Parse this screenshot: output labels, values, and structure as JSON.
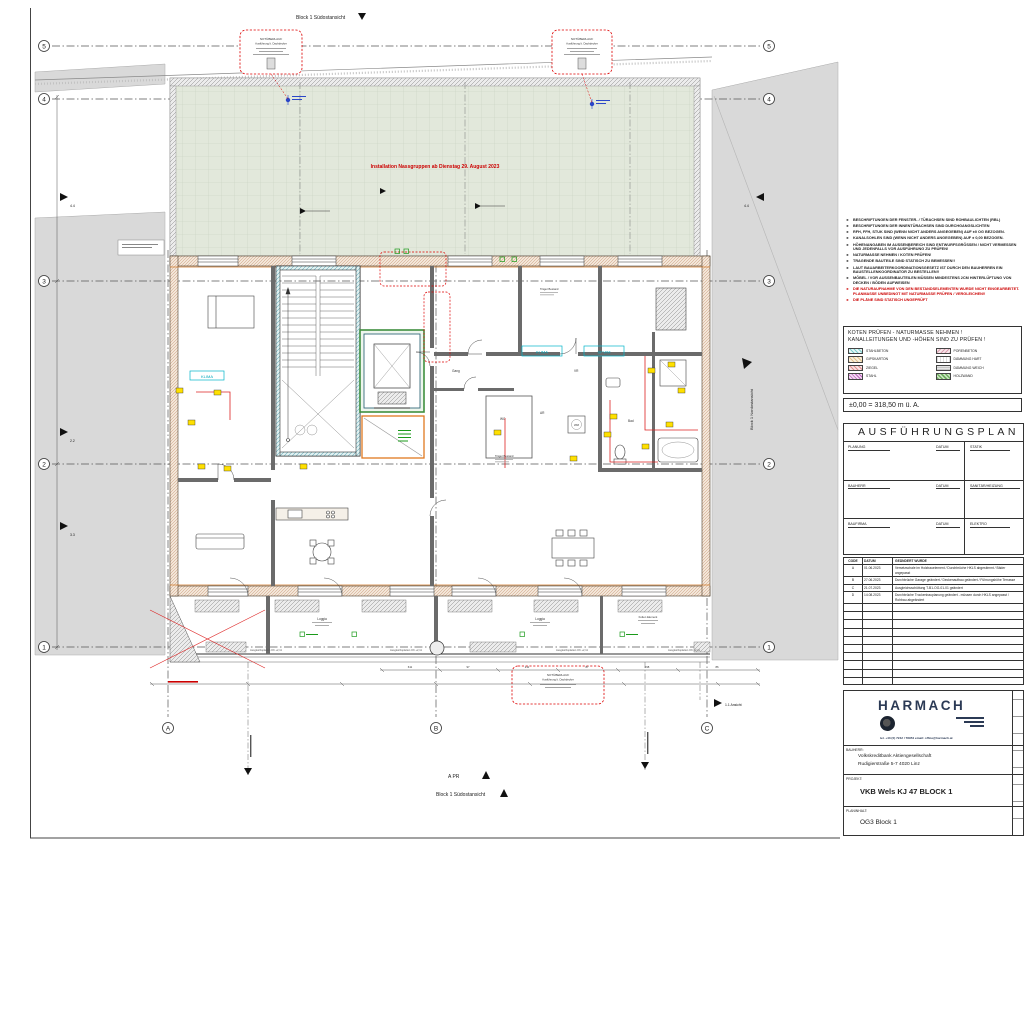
{
  "sheet": {
    "axis_rows": [
      "5",
      "4",
      "3",
      "2",
      "1"
    ],
    "axis_cols": [
      "A",
      "B",
      "C"
    ],
    "view_labels": {
      "top": "Block 1 Südostansicht",
      "bottom": "Block 1 Südostansicht",
      "right": "Block 1 Nordostansicht",
      "a_pr": "A PR",
      "ansicht_11": "1.1 Ansicht",
      "sec_44": "4.4",
      "sec_22": "2.2",
      "sec_33": "3.3"
    },
    "terrace_note": "Installation Nassgruppen ab Dienstag 29. August 2023",
    "overflow_label": {
      "title": "NOTÜBERLAUF",
      "subtitle": "Ausführung lt. Dachdecker"
    },
    "room_labels": {
      "loggia": "Loggia",
      "gang": "Gang",
      "bad": "Bad",
      "wc": "WC",
      "ar": "AR",
      "vr": "VR",
      "wm": "WM",
      "klima": "KLIMA",
      "spwm": "SP.WM",
      "traeger": "Träger Bestand",
      "folien": "Folien Element"
    },
    "plate_note": "Ausgleichsplatten OK +2,11",
    "dims_bottom": [
      "611",
      "97",
      "211",
      "87",
      "298",
      "86"
    ]
  },
  "notes": {
    "items": [
      {
        "text": "BESCHRIFTUNGEN DER FENSTER- / TÜRACHSEN SIND ROHBAULICHTEN (RBL)",
        "color": "#222222"
      },
      {
        "text": "BESCHRIFTUNGEN DER INNENTÜRACHSEN SIND DURCHGANGSLICHTEN",
        "color": "#222222"
      },
      {
        "text": "RFH, FFH, STUK SIND (WENN NICHT ANDERS ANGEGEBEN) AUF ±0 OG BEZOGEN.",
        "color": "#222222"
      },
      {
        "text": "KANALSOHLEN SIND (WENN NICHT ANDERS ANGEGEBEN) AUF ± 0,00 BEZOGEN.",
        "color": "#222222"
      },
      {
        "text": "HÖHENANGABEN IM AUSSENBEREICH SIND ENTWURFSGRÖSSEN / NICHT VERMESSEN UND JEDENFALLS VOR AUSFÜHRUNG ZU PRÜFEN!",
        "color": "#222222"
      },
      {
        "text": "NATURMASSE NEHMEN / KOTEN PRÜFEN!",
        "color": "#222222"
      },
      {
        "text": "TRAGENDE BAUTEILE SIND STATISCH ZU BEMESSEN!!",
        "color": "#222222"
      },
      {
        "text": "LAUT BAUARBEITERKOORDINATIONSGESETZ IST DURCH DEN BAUHERREN EIN BAUSTELLENKOORDINATOR ZU BESTELLEN!!",
        "color": "#222222"
      },
      {
        "text": "MÖBEL / VOR AUSSENBAUTEILEN MÜSSEN MINDESTENS 2CM HINTERLÜFTUNG VON DECKEN / BÖDEN AUFWEISEN",
        "color": "#222222"
      },
      {
        "text": "DIE NATURAUFNAHME VON DEN BESTANDSELEMENTEN WURDE NICHT EINGEARBEITET. PLANMASSE UNBEDINGT MIT NATURMASSE PRÜFEN / VERGLEICHEN!!",
        "color": "#cc0000"
      },
      {
        "text": "DIE PLÄNE SIND STATISCH UNGEPRÜFT",
        "color": "#cc0000"
      }
    ]
  },
  "legend_box": {
    "title1": "KOTEN PRÜFEN - NATURMASSE NEHMEN !",
    "title2": "KANALLEITUNGEN UND -HÖHEN SIND ZU PRÜFEN !",
    "items": [
      {
        "label": "STAHLBETON",
        "color": "#8fd2d2"
      },
      {
        "label": "PORENBETON",
        "color": "#e3aebc"
      },
      {
        "label": "GIPSKARTON",
        "color": "#ecd9b0"
      },
      {
        "label": "DÄMMUNG HART",
        "color": "#ffffff"
      },
      {
        "label": "ZIEGEL",
        "color": "#e49c9c"
      },
      {
        "label": "DÄMMUNG WEICH",
        "color": "#cccccc"
      },
      {
        "label": "STAHL",
        "color": "#c86ec8"
      },
      {
        "label": "HOLZWAND",
        "color": "#7fae6a"
      }
    ]
  },
  "level_line": "±0,00 = 318,50 m ü. A.",
  "titleblock": {
    "header": "AUSFÜHRUNGSPLAN",
    "fields": {
      "planung": "PLANUNG",
      "datum": "DATUM",
      "statik": "STATIK",
      "bauherr": "BAUHERR",
      "sanitaer": "SANITÄR/HEIZUNG",
      "baufirma": "BAUFIRMA",
      "elektro": "ELEKTRO"
    },
    "rev_header": {
      "code": "CODE",
      "datum": "DATUM",
      "text": "GEÄNDERT WURDE"
    },
    "revisions": [
      {
        "code": "A",
        "datum": "01.06.2023",
        "text": "Versetzschale im Holzbauelement / Durchbrüche HKLS abgestimmt / Bäder angepasst"
      },
      {
        "code": "B",
        "datum": "27.06.2023",
        "text": "Durchbrüche Garage geändert / Deckenaufbau geändert / Führungshöhe Terrasse"
      },
      {
        "code": "C",
        "datum": "21.07.2023",
        "text": "Ausgleichsschüttung T-B1-OG-01-01 geändert"
      },
      {
        "code": "D",
        "datum": "14.08.2023",
        "text": "Durchbrüche Trockenbauplanung geändert - müssen durch HKLS angepasst / Rohbau abgeändert"
      }
    ]
  },
  "company": {
    "logo": "HARMACH",
    "contact": "tel. +43 (0) 7242 / 78954    email: office@harmach.at",
    "bauherr_label": "BAUHERR:",
    "bauherr_line1": "Volkskreditbank Aktiengesellschaft",
    "bauherr_line2": "Rudigierstraße 5-7 4020 Linz",
    "projekt_label": "PROJEKT:",
    "projekt": "VKB Wels KJ 47 BLOCK 1",
    "planinhalt_label": "PLANINHALT:",
    "planinhalt": "OG3 Block 1"
  }
}
